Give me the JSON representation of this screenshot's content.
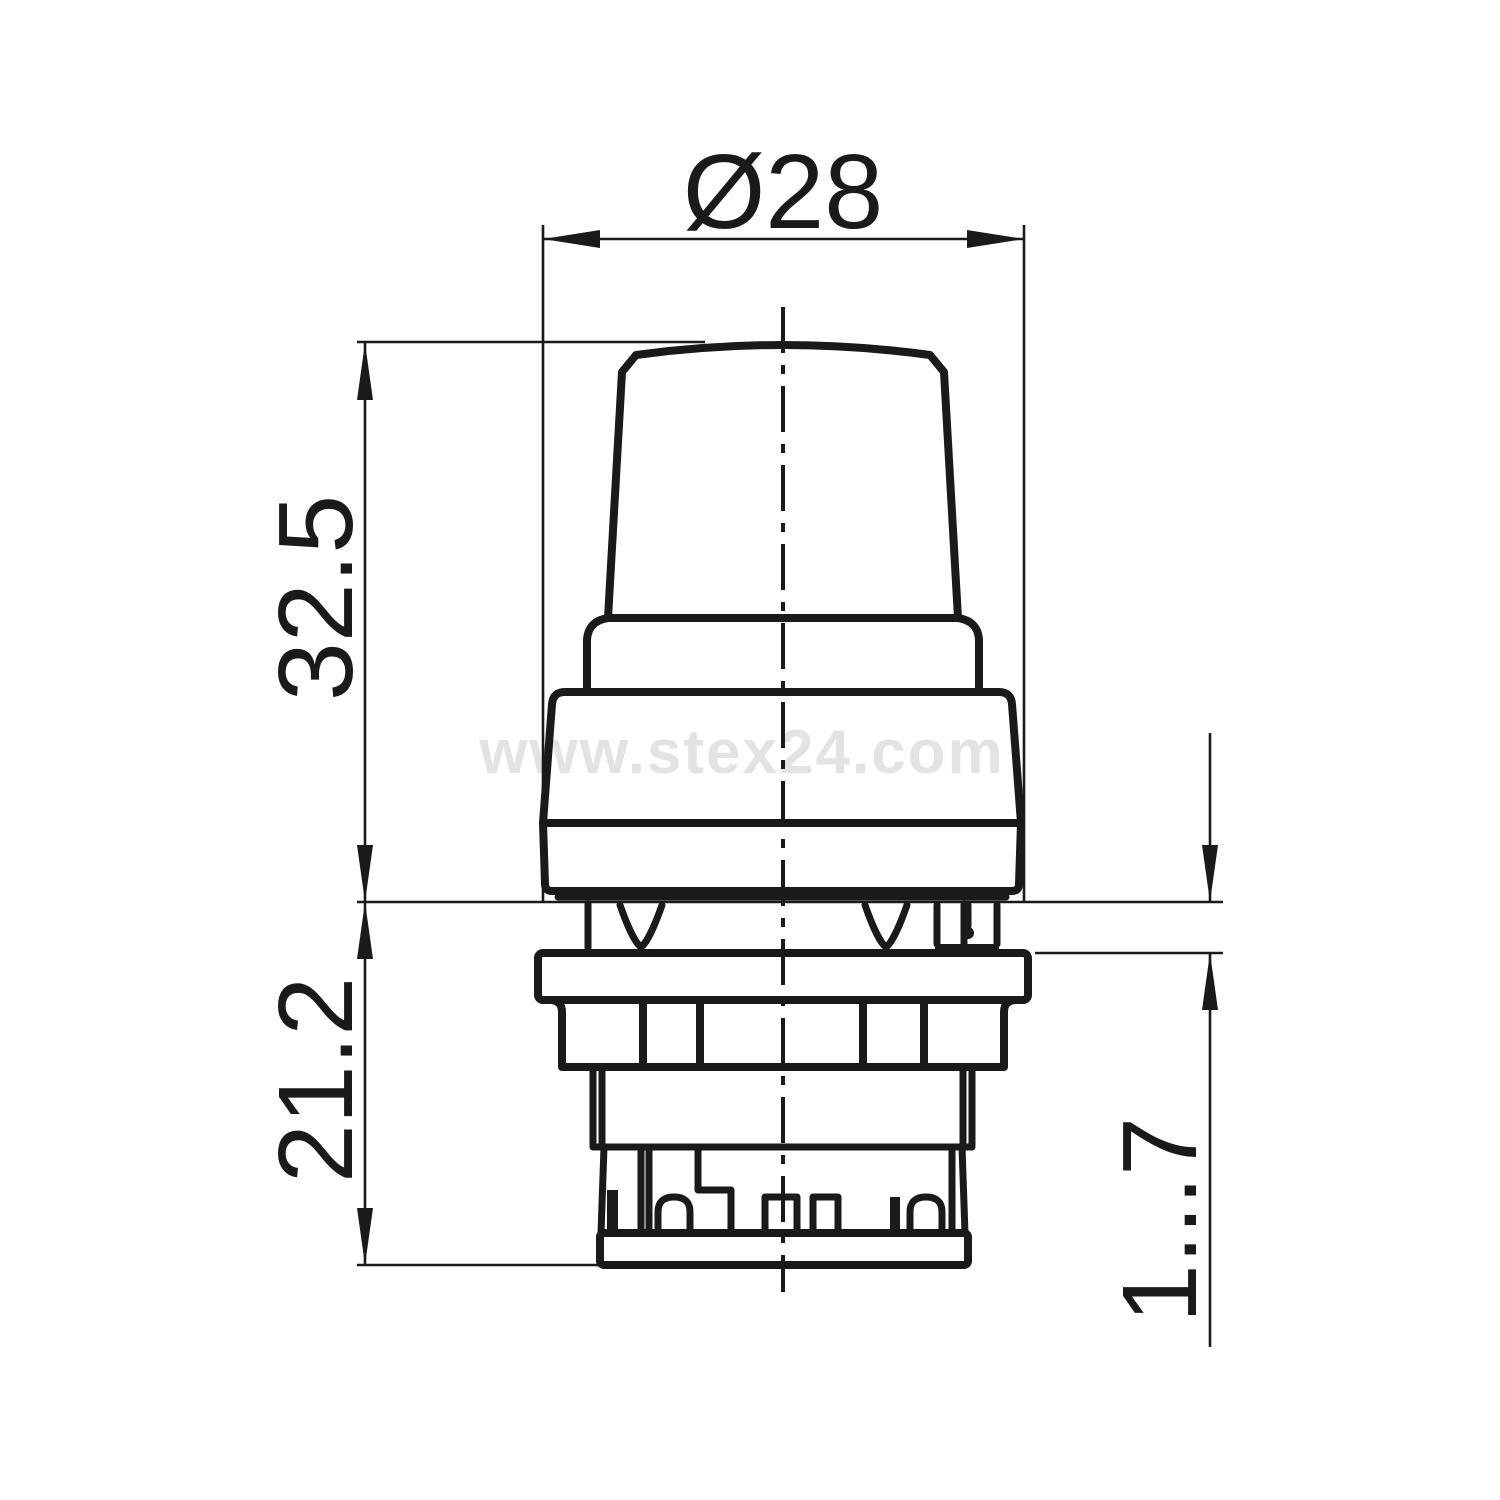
{
  "drawing": {
    "type": "technical-dimension-drawing",
    "watermark": {
      "text": "www.stex24.com"
    },
    "dimensions": {
      "diameter_top": {
        "label": "Ø28"
      },
      "height_upper": {
        "label": "32.5"
      },
      "height_lower": {
        "label": "21.2"
      },
      "panel_range": {
        "label": "1...7"
      }
    },
    "colors": {
      "line": "#1a1a1a",
      "watermark": "#e3e3e3",
      "background": "#ffffff"
    }
  }
}
